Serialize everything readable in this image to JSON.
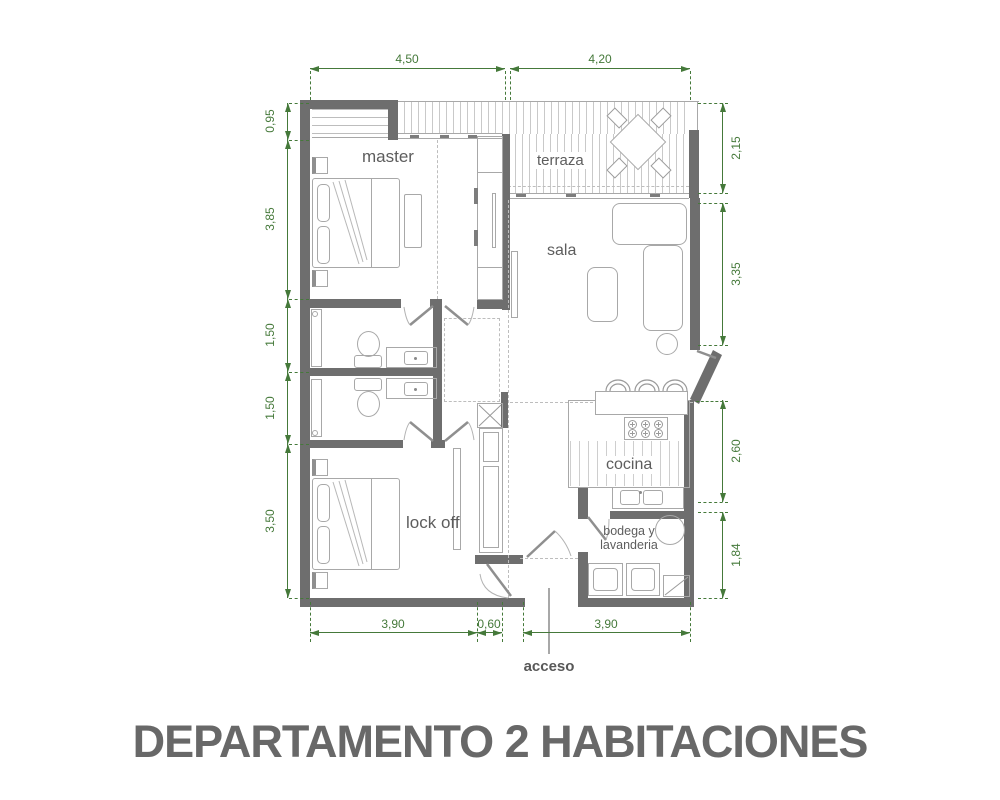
{
  "title": "DEPARTAMENTO 2 HABITACIONES",
  "drawing_type": "apartment floor plan",
  "rooms": {
    "master": "master",
    "terraza": "terraza",
    "sala": "sala",
    "cocina": "cocina",
    "lock_off": "lock off",
    "bodega_line1": "bodega y",
    "bodega_line2": "lavanderia",
    "acceso": "acceso"
  },
  "dimensions": {
    "top": [
      "4,50",
      "4,20"
    ],
    "left": [
      "0,95",
      "3,85",
      "1,50",
      "1,50",
      "3,50"
    ],
    "right": [
      "2,15",
      "3,35",
      "2,60",
      "1,84"
    ],
    "bottom": [
      "3,90",
      "0,60",
      "3,90"
    ]
  },
  "colors": {
    "wall": "#6e6e6e",
    "dimension_green": "#45793a",
    "drawing_line": "#a8a8a8",
    "label_text": "#5d5d5d",
    "title_text": "#686868"
  }
}
